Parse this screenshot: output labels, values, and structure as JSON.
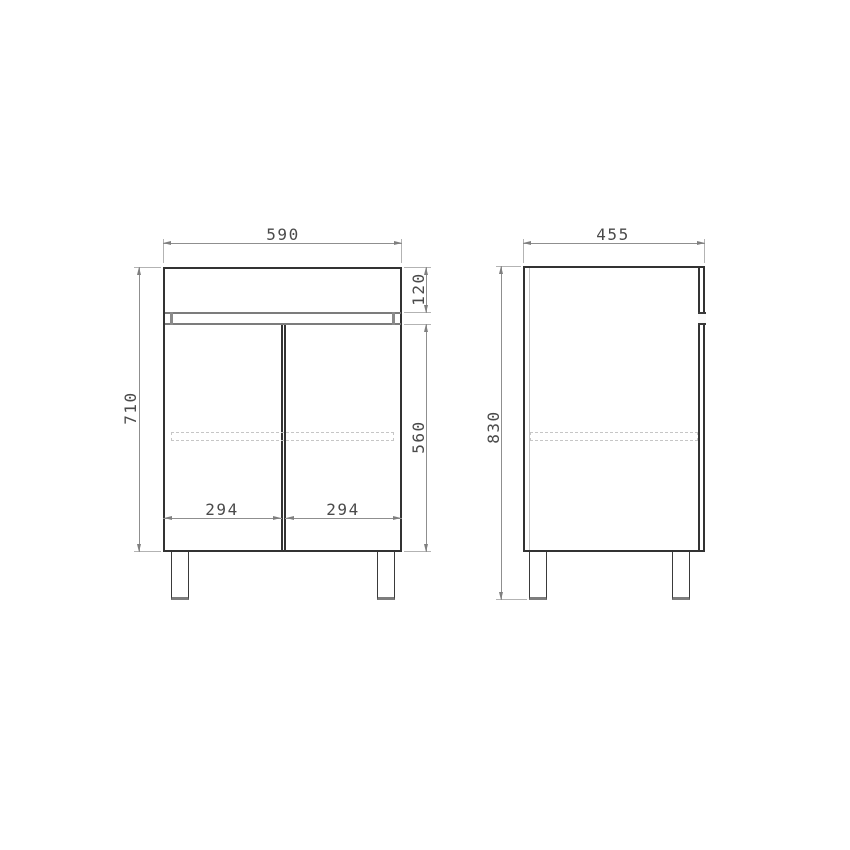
{
  "drawing": {
    "kind": "technical-dimension-drawing",
    "subject": "two-door floor cabinet, front and side elevation views",
    "colors": {
      "background": "#ffffff",
      "outline": "#323232",
      "secondary_line": "#7c7c7c",
      "dimension_line": "#8f8f8f",
      "dimension_text": "#4a4a4a",
      "hidden_line": "#c6c6c6"
    },
    "views": {
      "front": {
        "dimensions": {
          "overall_width": "590",
          "overall_height": "710",
          "top_section_height": "120",
          "door_height": "560",
          "left_door_width": "294",
          "right_door_width": "294"
        }
      },
      "side": {
        "dimensions": {
          "depth": "455",
          "total_height_with_legs": "830"
        }
      }
    }
  }
}
